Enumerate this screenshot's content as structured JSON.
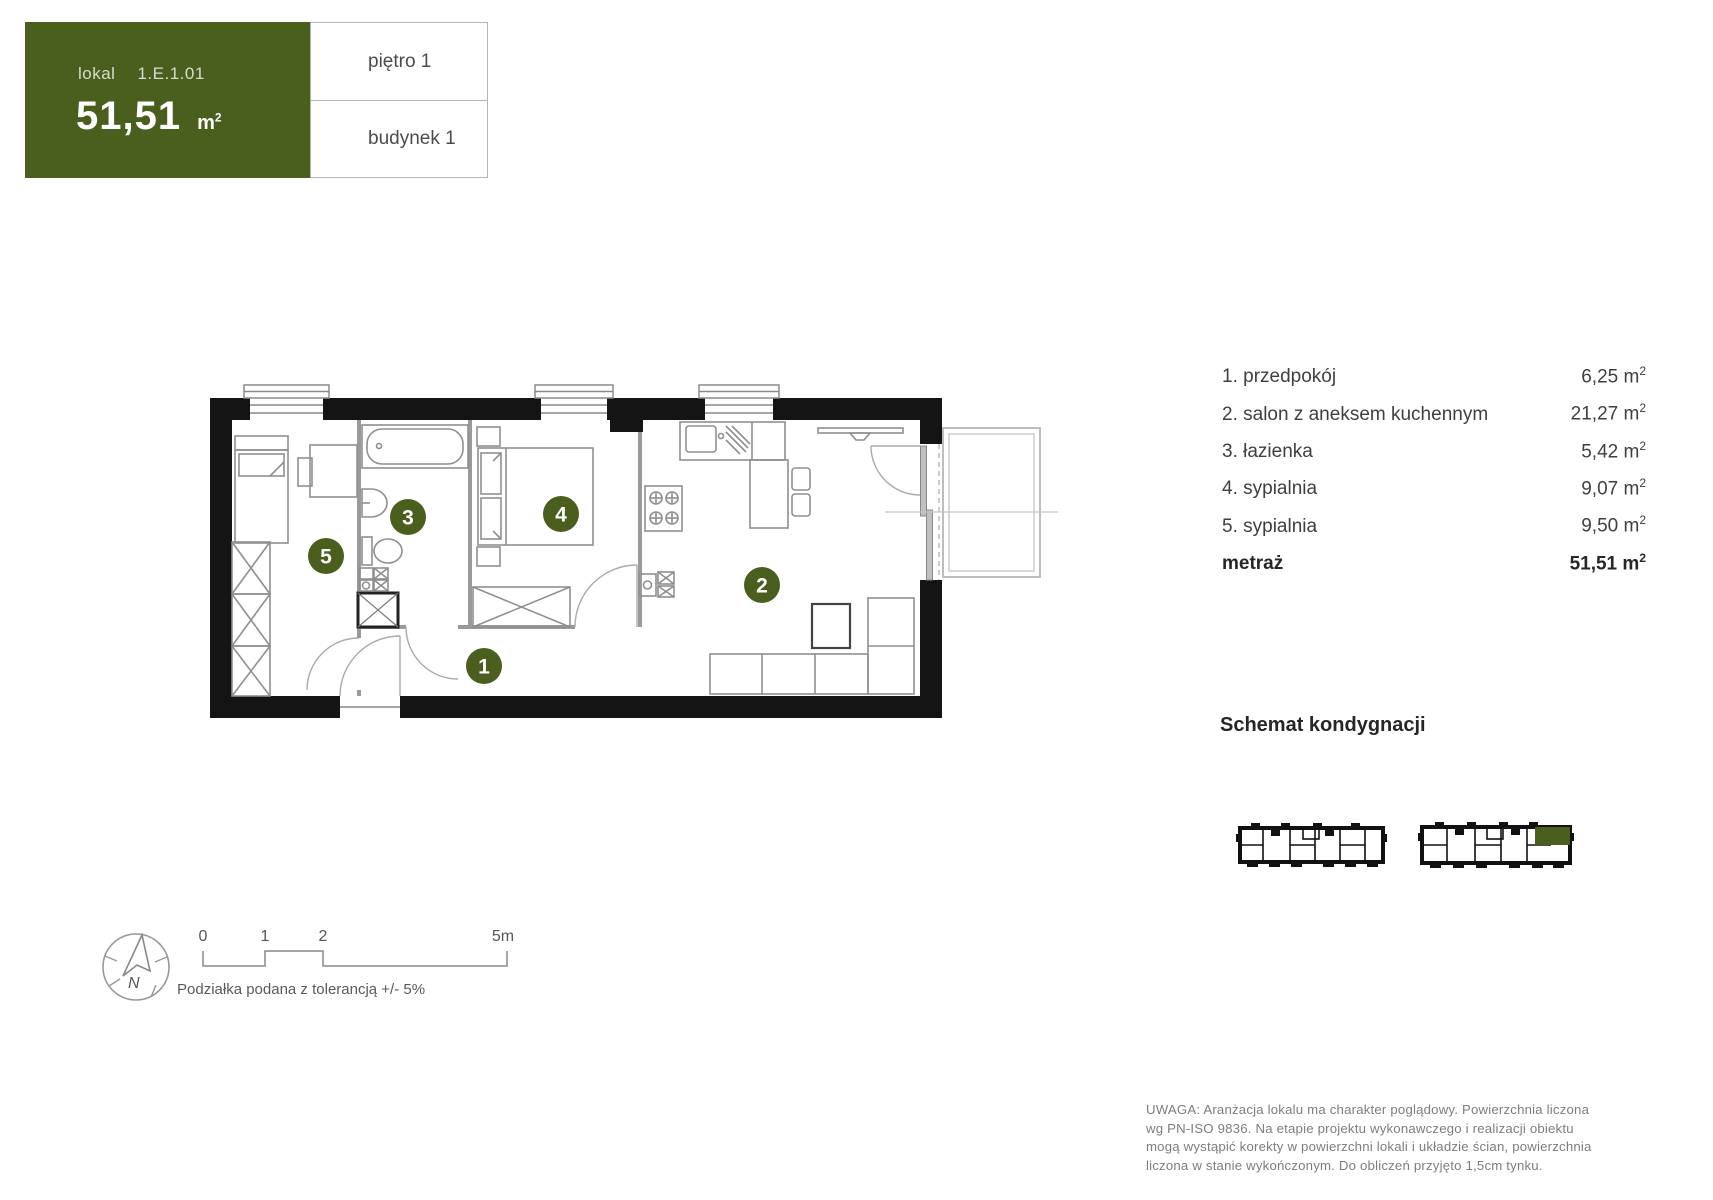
{
  "colors": {
    "accent_green": "#4a5e1d",
    "wall_black": "#141414"
  },
  "header": {
    "lokal_label": "lokal",
    "lokal_value": "1.E.1.01",
    "area_value": "51,51",
    "area_unit": "m",
    "area_unit_sup": "2",
    "floor_label": "piętro 1",
    "building_label": "budynek 1"
  },
  "plan": {
    "room_markers": [
      "1",
      "2",
      "3",
      "4",
      "5"
    ]
  },
  "legend": {
    "rooms": [
      {
        "index": "1.",
        "name": "przedpokój",
        "area": "6,25"
      },
      {
        "index": "2.",
        "name": "salon z aneksem kuchennym",
        "area": "21,27"
      },
      {
        "index": "3.",
        "name": "łazienka",
        "area": "5,42"
      },
      {
        "index": "4.",
        "name": "sypialnia",
        "area": "9,07"
      },
      {
        "index": "5.",
        "name": "sypialnia",
        "area": "9,50"
      }
    ],
    "total_label": "metraż",
    "total_area": "51,51",
    "unit": "m",
    "unit_sup": "2"
  },
  "schemat": {
    "title": "Schemat kondygnacji"
  },
  "scale": {
    "ticks": [
      "0",
      "1",
      "2",
      "5m"
    ],
    "note": "Podziałka podana z tolerancją +/- 5%"
  },
  "compass": {
    "north_label": "N"
  },
  "disclaimer": {
    "lines": [
      "UWAGA: Aranżacja lokalu ma charakter poglądowy. Powierzchnia liczona",
      "wg PN-ISO 9836. Na etapie projektu wykonawczego i realizacji obiektu",
      "mogą wystąpić korekty w powierzchni lokali i układzie ścian, powierzchnia",
      "liczona w stanie wykończonym. Do obliczeń przyjęto 1,5cm tynku."
    ]
  }
}
